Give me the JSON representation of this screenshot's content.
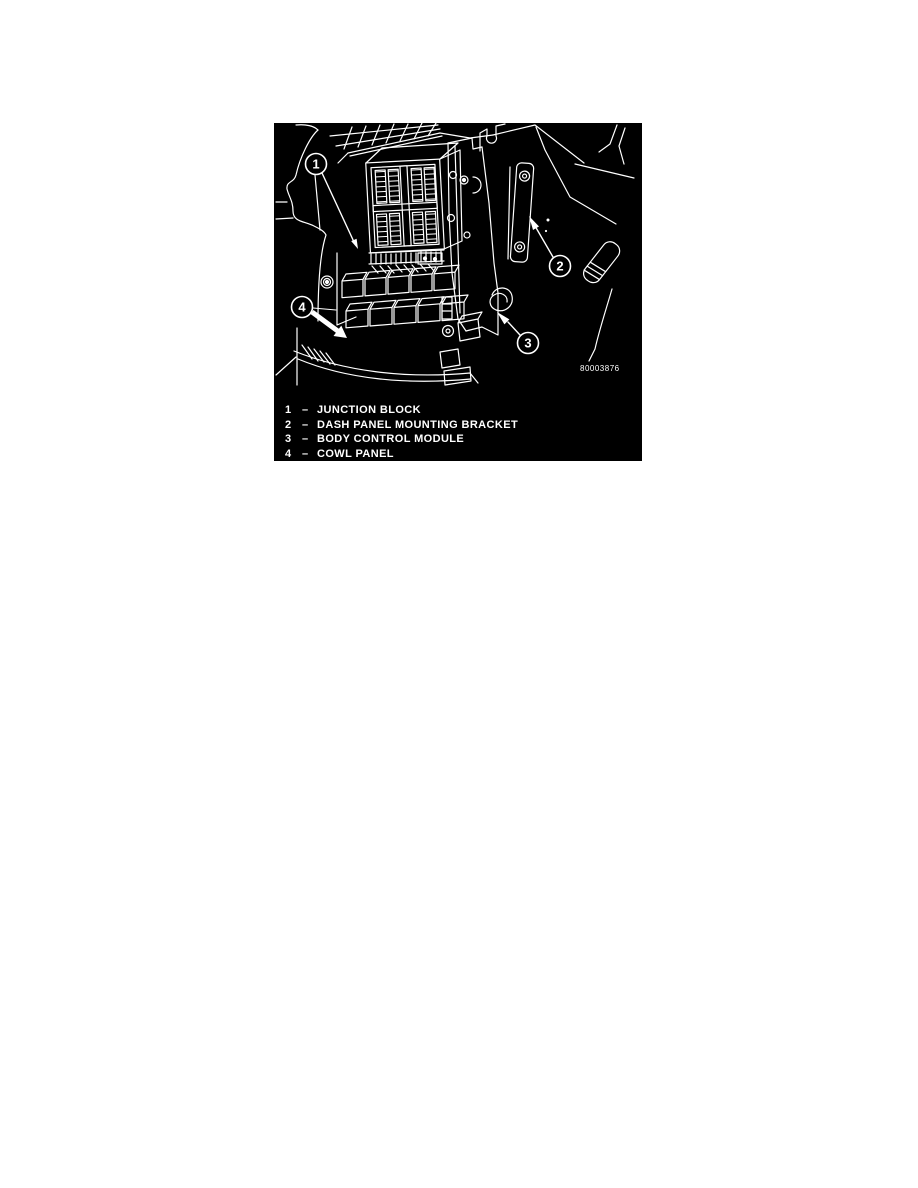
{
  "page": {
    "background": "#ffffff"
  },
  "figure": {
    "colors": {
      "background": "#000000",
      "line": "#ffffff"
    },
    "figure_number": "80003876",
    "callouts": [
      {
        "number": "1"
      },
      {
        "number": "2"
      },
      {
        "number": "3"
      },
      {
        "number": "4"
      }
    ],
    "legend": {
      "separator": "–",
      "items": [
        {
          "number": "1",
          "label": "JUNCTION BLOCK"
        },
        {
          "number": "2",
          "label": "DASH PANEL MOUNTING BRACKET"
        },
        {
          "number": "3",
          "label": "BODY CONTROL MODULE"
        },
        {
          "number": "4",
          "label": "COWL PANEL"
        }
      ]
    }
  }
}
